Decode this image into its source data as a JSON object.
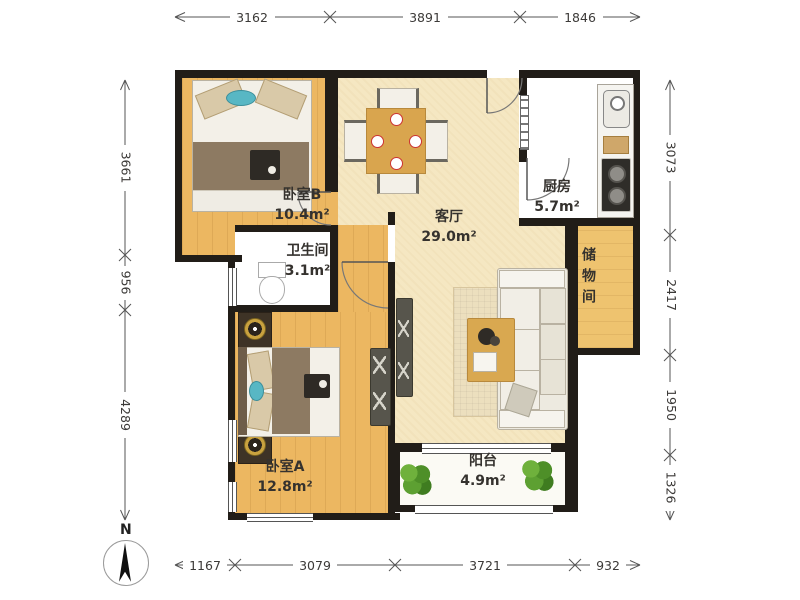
{
  "rooms": {
    "bedroom_b": {
      "label": "卧室B",
      "area": "10.4m²"
    },
    "living": {
      "label": "客厅",
      "area": "29.0m²"
    },
    "kitchen": {
      "label": "厨房",
      "area": "5.7m²"
    },
    "bathroom": {
      "label": "卫生间",
      "area": "3.1m²"
    },
    "storage": {
      "label": "储物间"
    },
    "bedroom_a": {
      "label": "卧室A",
      "area": "12.8m²"
    },
    "balcony": {
      "label": "阳台",
      "area": "4.9m²"
    }
  },
  "dimensions": {
    "top": [
      "3162",
      "3891",
      "1846"
    ],
    "left": [
      "3661",
      "956",
      "4289"
    ],
    "right": [
      "3073",
      "2417",
      "1950",
      "1326"
    ],
    "bottom": [
      "1167",
      "3079",
      "3721",
      "932"
    ]
  },
  "compass": {
    "label": "N"
  },
  "colors": {
    "wall": "#211d18",
    "wood_floor": "#ecb761",
    "living_floor": "#f5e7c2",
    "tile_floor": "#f4f3ee",
    "plant_green": "#58992e",
    "dimension_text": "#3c3a38"
  }
}
